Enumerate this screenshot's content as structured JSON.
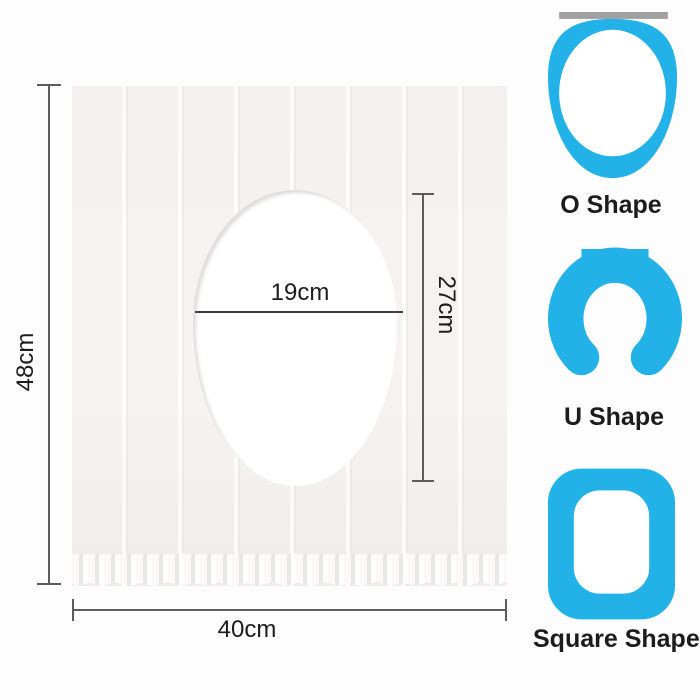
{
  "diagram": {
    "height_label": "48cm",
    "width_label": "40cm",
    "hole_width_label": "19cm",
    "hole_height_label": "27cm"
  },
  "shape_options": [
    {
      "label": "O Shape",
      "icon": "o-shape-seat-icon"
    },
    {
      "label": "U Shape",
      "icon": "u-shape-seat-icon"
    },
    {
      "label": "Square Shape",
      "icon": "square-shape-seat-icon"
    }
  ],
  "colors": {
    "accent_blue": "#23b2e7",
    "hinge_gray": "#a0a0a0",
    "sheet_fill": "#f5f1f1",
    "line_color": "#5c5c5c",
    "text_color": "#1c1c1c"
  }
}
